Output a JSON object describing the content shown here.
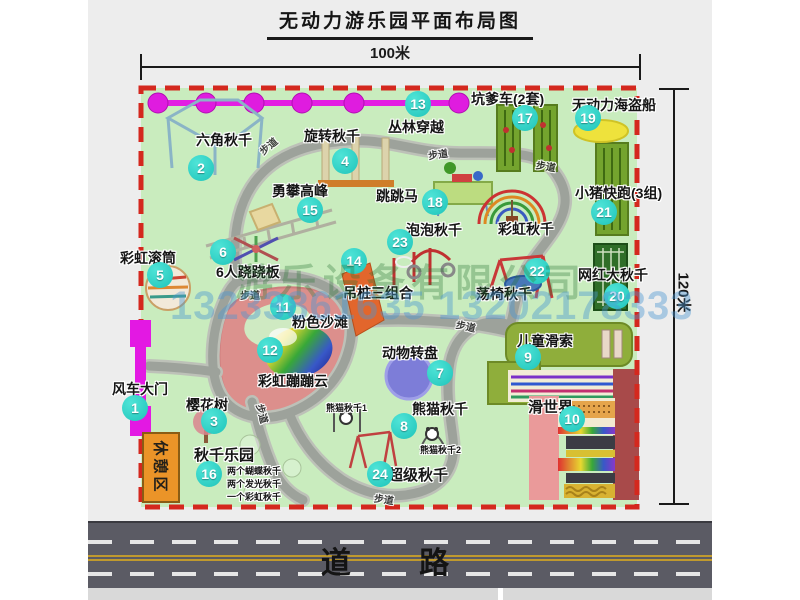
{
  "title": "无动力游乐园平面布局图",
  "dimension_top": "100米",
  "dimension_right": "120米",
  "road_label": "道 路",
  "rest_area_label": "休憩区",
  "path_label": "步道",
  "watermark": {
    "company": "游乐设备有限公司",
    "phones": "13233861635 13202178333"
  },
  "unnumbered_labels": [
    {
      "name": "彩虹秋千"
    }
  ],
  "attractions": [
    {
      "num": "1",
      "name": "风车大门"
    },
    {
      "num": "2",
      "name": "六角秋千"
    },
    {
      "num": "3",
      "name": "樱花树"
    },
    {
      "num": "4",
      "name": "旋转秋千"
    },
    {
      "num": "5",
      "name": "彩虹滚筒"
    },
    {
      "num": "6",
      "name": "6人跷跷板"
    },
    {
      "num": "7",
      "name": "动物转盘"
    },
    {
      "num": "8",
      "name": "熊猫秋千",
      "notes": [
        "熊猫秋千1",
        "熊猫秋千2"
      ]
    },
    {
      "num": "9",
      "name": "儿童滑索"
    },
    {
      "num": "10",
      "name": "滑世界"
    },
    {
      "num": "11",
      "name": "粉色沙滩"
    },
    {
      "num": "12",
      "name": "彩虹蹦蹦云"
    },
    {
      "num": "13",
      "name": "丛林穿越"
    },
    {
      "num": "14",
      "name": "吊桩三组合"
    },
    {
      "num": "15",
      "name": "勇攀高峰"
    },
    {
      "num": "16",
      "name": "秋千乐园",
      "notes": [
        "两个蝴蝶秋千",
        "两个发光秋千",
        "一个彩虹秋千"
      ]
    },
    {
      "num": "17",
      "name": "坑爹车(2套)"
    },
    {
      "num": "18",
      "name": "跳跳马"
    },
    {
      "num": "19",
      "name": "无动力海盗船"
    },
    {
      "num": "20",
      "name": "网红大秋千"
    },
    {
      "num": "21",
      "name": "小猪快跑(3组)"
    },
    {
      "num": "22",
      "name": "荡椅秋千"
    },
    {
      "num": "23",
      "name": "泡泡秋千"
    },
    {
      "num": "24",
      "name": "超级秋千"
    }
  ],
  "colors": {
    "park_green": "#c9ecbe",
    "border_red": "#d4281e",
    "badge_teal": "#2bd2c5",
    "gate_magenta": "#e318e3",
    "chain_pink": "#df1cdf",
    "rest_orange": "#eb9428",
    "road_gray": "#5b5b64"
  }
}
